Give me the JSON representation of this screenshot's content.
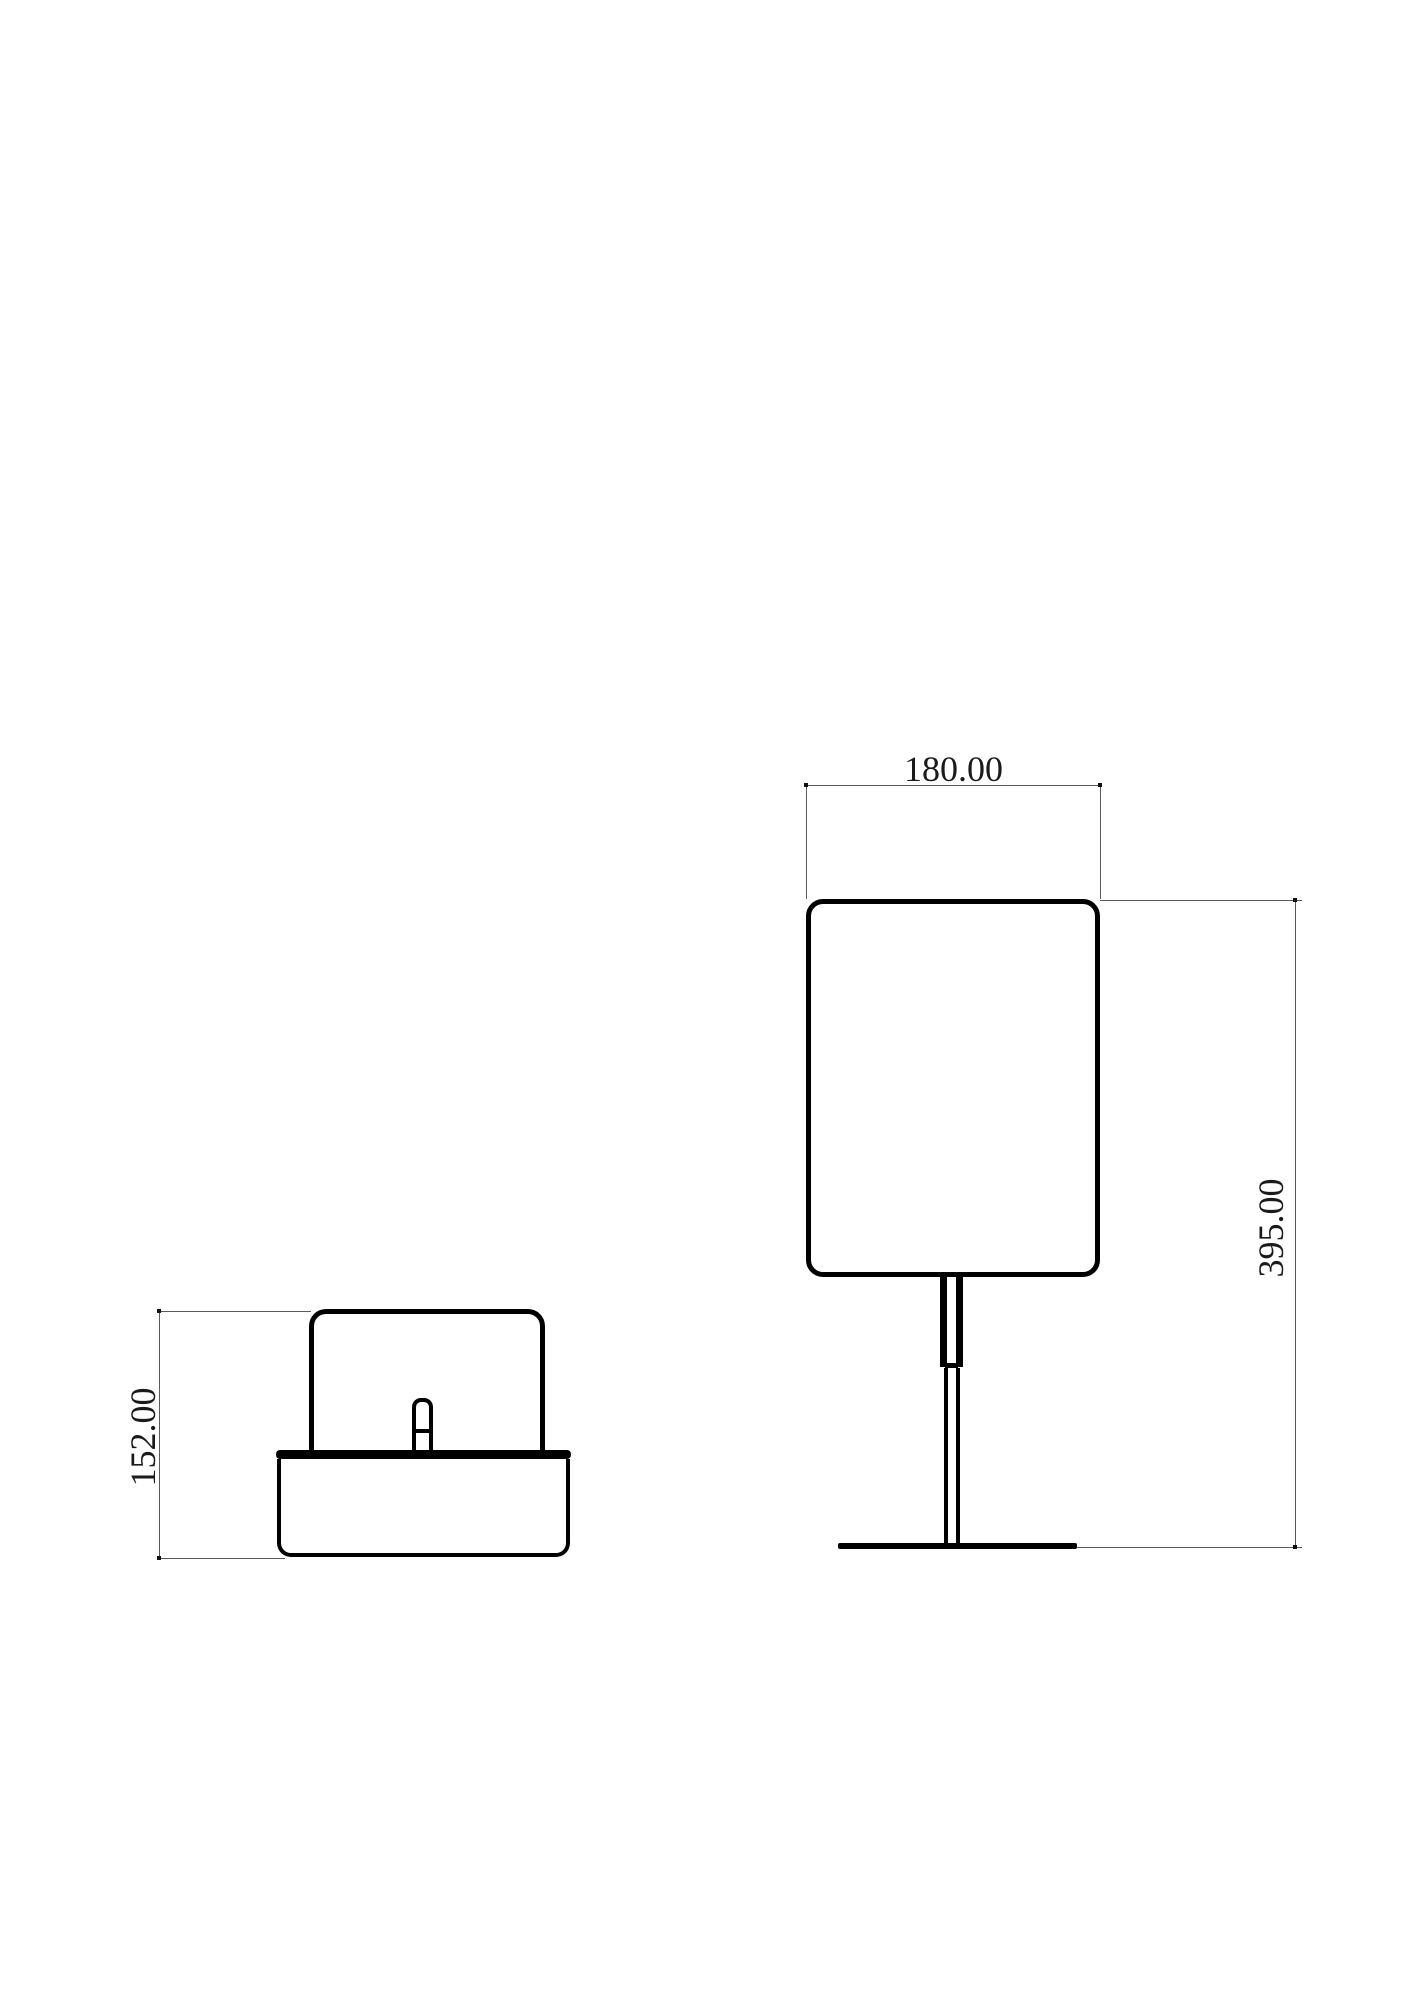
{
  "drawing": {
    "type": "cad-orthographic-drawing",
    "subject": "table-lamp",
    "dimensions": {
      "front_width": "180.00",
      "front_height": "395.00",
      "side_height": "152.00"
    },
    "colors": {
      "background": "#ffffff",
      "outline": "#000000",
      "dimension_line": "#5a5a5a",
      "text": "#1a1a1a"
    }
  }
}
